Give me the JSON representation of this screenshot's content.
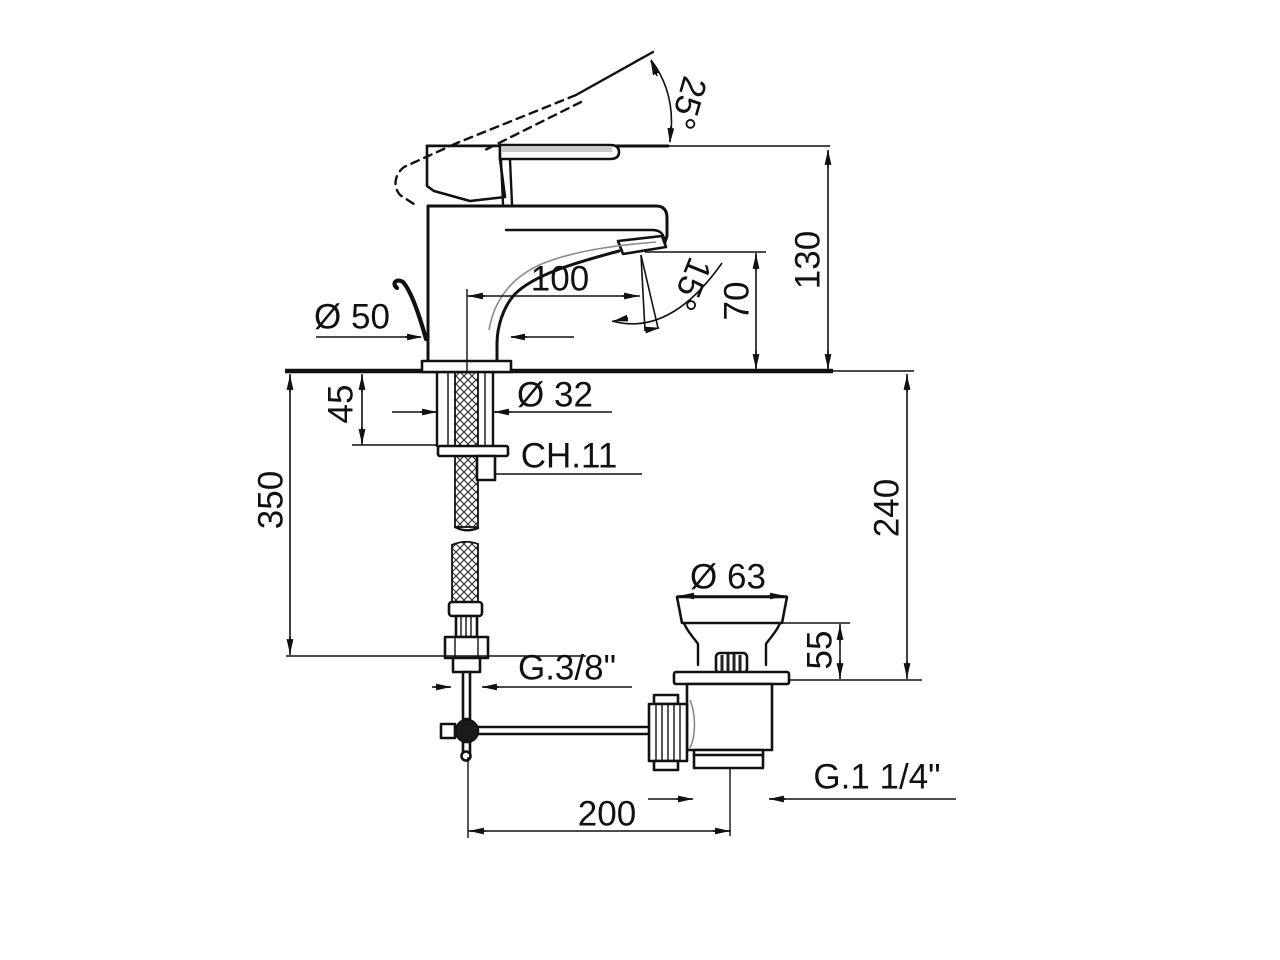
{
  "drawing": {
    "title": "Single-lever basin mixer with pop-up waste — dimensional drawing",
    "units": "mm",
    "colors": {
      "line": "#111111",
      "background": "#ffffff",
      "lever_shade": "#c9c9c9"
    },
    "labels": {
      "handle_open_angle": "25°",
      "height_above_deck": "130",
      "spout_reach": "100",
      "aerator_tilt_angle": "15°",
      "outlet_height": "70",
      "base_diameter": "Ø 50",
      "shank_diameter": "Ø 32",
      "max_deck_thickness": "45",
      "wrench_size": "CH.11",
      "hose_drop_length": "350",
      "below_deck_height": "240",
      "waste_cap_diameter": "Ø 63",
      "waste_cap_height": "55",
      "supply_thread": "G.3/8\"",
      "waste_thread": "G.1 1/4\"",
      "rod_to_waste_offset": "200"
    }
  }
}
